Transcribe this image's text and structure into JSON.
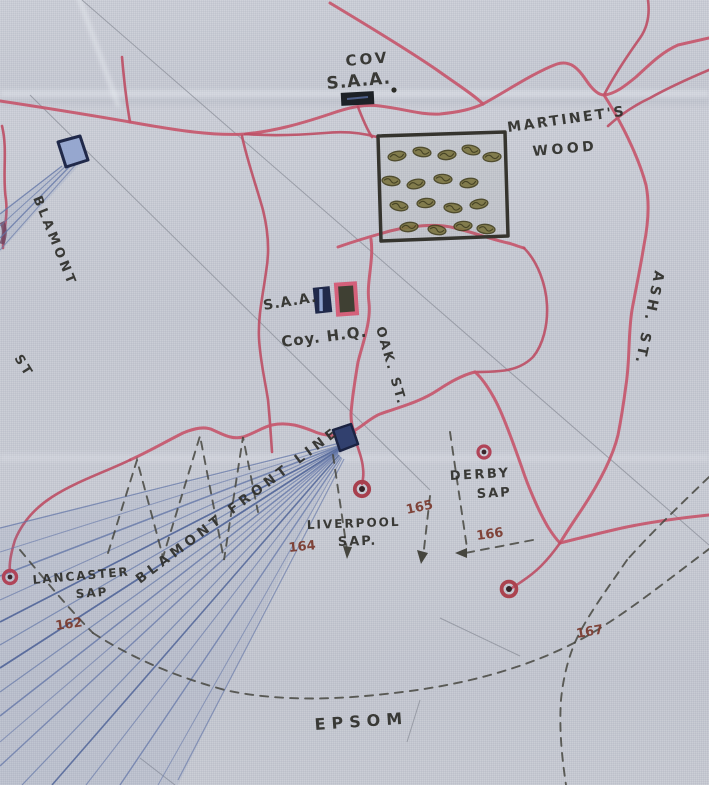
{
  "map": {
    "type": "hand-drawn trench map on linen",
    "colors": {
      "background_linen": "#c7cad3",
      "trench_red": "#c5576c",
      "ink_black": "#31312c",
      "number_ink": "#7a3a2e",
      "mine_fan_blue": "#6477a8",
      "dashed_line": "#46463f",
      "wood_outline": "#35342e"
    },
    "markers": {
      "ammo_store_rect": "small filled rectangle (S.A.A. store)",
      "hq_rects": "navy rectangle and red-bordered rectangle at Coy. H.Q.",
      "sap_head_circle": "small red ring with dark centre at each sap head",
      "mine_fan": "blue radiating fan from a rectangular charge-head",
      "wood_square": "black square filled with olive tree scribbles",
      "boundary_arc": "long dashed arc labelled EPSOM"
    }
  },
  "labels": {
    "cov": {
      "l1": "COV",
      "l2": "S.A.A."
    },
    "wood": {
      "l1": "MARTINET'S",
      "l2": "WOOD"
    },
    "blamont": {
      "name": "BLAMONT",
      "st": "ST"
    },
    "hq": {
      "saa": "S.A.A.",
      "coy": "Coy. H.Q."
    },
    "streets": {
      "oak": "OAK. ST.",
      "ash": "ASH. ST."
    },
    "saps": {
      "derby1": "DERBY",
      "derby2": "SAP",
      "liv1": "LIVERPOOL",
      "liv2": "SAP.",
      "lan1": "LANCASTER",
      "lan2": "SAP"
    },
    "front_line": "BLAMONT FRONT LINE",
    "epsom": "EPSOM",
    "numbers": {
      "n162": "162",
      "n164": "164",
      "n165": "165",
      "n166": "166",
      "n167": "167"
    }
  }
}
